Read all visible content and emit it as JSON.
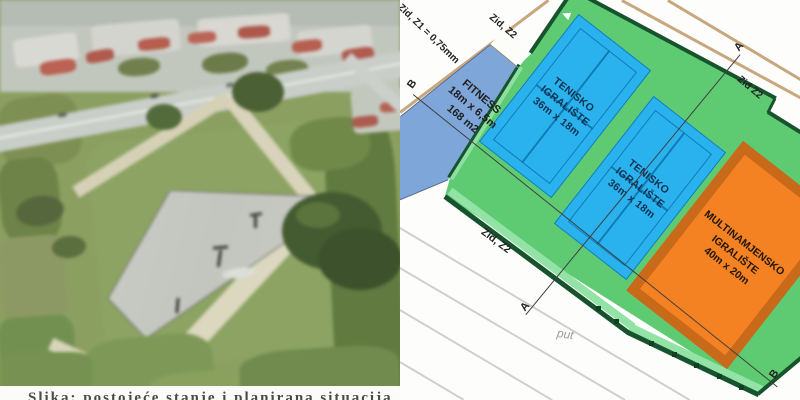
{
  "photo": {
    "caption": "Slika: postojeće stanje i planirana situacija"
  },
  "plan": {
    "wall_labels": {
      "z1": "Zid, Z1 = 0,75mm",
      "z2_top": "Zid, Z2",
      "z2_right": "Zid Z2",
      "z2_bottom": "Zid, Z2"
    },
    "road_label": "put",
    "section_labels": {
      "a_top": "A",
      "a_bottom": "A",
      "b_left": "B",
      "b_right": "B"
    },
    "fitness": {
      "name": "FITNESS",
      "dims": "18m x 6,5m",
      "area": "168 m2"
    },
    "tennis_court_1": {
      "name_line1": "TENISKO",
      "name_line2": "IGRALIŠTE",
      "dims": "36m x 18m"
    },
    "tennis_court_2": {
      "name_line1": "TENISKO",
      "name_line2": "IGRALIŠTE",
      "dims": "36m x 18m"
    },
    "multipurpose": {
      "name_line1": "MULTINAMJENSKO",
      "name_line2": "IGRALIŠTE",
      "dims": "40m x 20m"
    },
    "colors": {
      "field_green": "#5ecb73",
      "court_blue": "#29b2ee",
      "fitness_blue": "#7ea6d9",
      "multi_orange": "#f58222",
      "multi_border": "#c9691a",
      "wall_green": "#17532d",
      "road_tan": "#c7a87e"
    }
  }
}
